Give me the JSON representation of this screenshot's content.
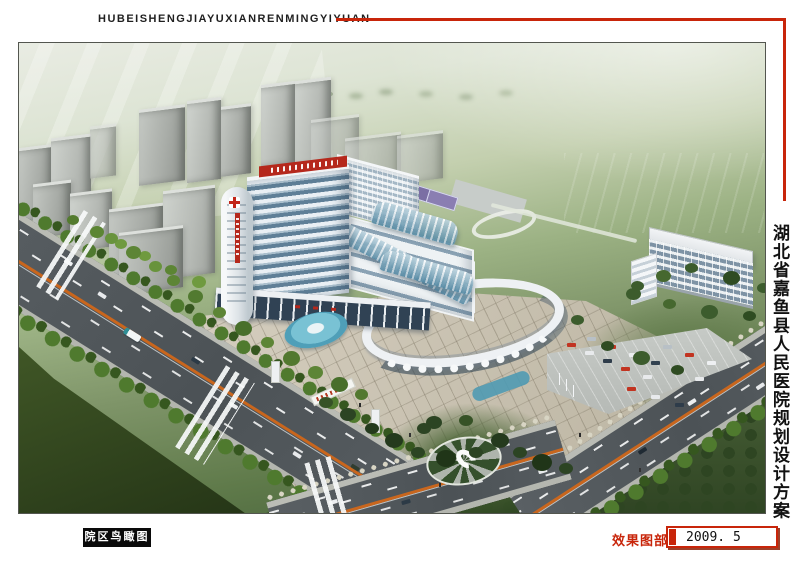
{
  "header": {
    "title_roman": "HUBEISHENGJIAYUXIANRENMINGYIYUAN"
  },
  "side": {
    "title_cn": "湖北省嘉鱼县人民医院规划设计方案"
  },
  "caption": {
    "label": "院区鸟瞰图"
  },
  "footer": {
    "section": "效果图部分",
    "date": "2009. 5"
  },
  "colors": {
    "accent_red": "#c8250a",
    "banner_red": "#b5281c",
    "lane_orange": "#c9661d",
    "building_white": "#eef1f4",
    "glass_blue": "#7fa8c8",
    "road_gray": "#50565a",
    "lawn_green": "#7e9468",
    "tree_green": "#3a5c28",
    "plaza_tan": "#d6cfc0"
  },
  "scene": {
    "type": "architectural-aerial-rendering",
    "subject": "Hospital campus bird's-eye view with inpatient tower, oval outpatient building, lawns, roads and parking"
  }
}
